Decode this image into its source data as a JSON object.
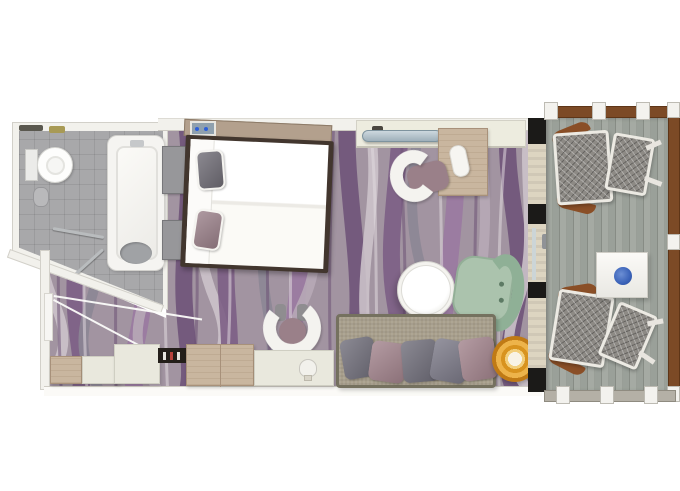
{
  "page": {
    "title": "Balcony stateroom floor plan"
  },
  "rooms": {
    "bathroom": {
      "name": "Bathroom",
      "fixtures": [
        "toilet",
        "hand shower",
        "grab bars",
        "shower corner",
        "bathtub with seat"
      ]
    },
    "stateroom": {
      "name": "Stateroom",
      "furniture": [
        "double bed with gray and mauve pillows",
        "two nightstands",
        "headboard panel with control pad",
        "TV console with wall-mounted TV",
        "writing desk",
        "desk chair with mauve cushion",
        "round white coffee table",
        "sage green armchair",
        "sofa with five cushions",
        "gold round pouf",
        "vanity chair",
        "wardrobe cabinets",
        "minibar niche",
        "vanity cabinet",
        "entrance door with swing"
      ]
    },
    "balcony": {
      "name": "Balcony",
      "furniture": [
        "woven lounge chair",
        "woven lounge chair",
        "white side table with blue bowl",
        "wood deck",
        "railing with posts"
      ]
    }
  },
  "colors": {
    "wall": "#f2f1ec",
    "bath-floor": "#a8a8aa",
    "carpet-base": "#a294a1",
    "bed-frame": "#42362e",
    "duvet": "#f7f6f2",
    "pillow-gray": "#6f6c75",
    "pillow-mauve": "#9a8089",
    "wood": "#c9b69f",
    "wood-dark": "#a8917a",
    "cream": "#e9e8dd",
    "sofa": "#a89f8c",
    "sofa-edge": "#75715f",
    "green-seat": "#abc3ad",
    "green-back": "#8fb096",
    "pouf-gold": "#e8a93c",
    "pouf-deep": "#c07a15",
    "deck": "#9ba19b",
    "rail-brown": "#7c4a26",
    "mesh": "#8d8a85",
    "divider": "#ddd5c1",
    "tv": "#aebfc9",
    "dish-blue": "#3a62b8",
    "white-fixture": "#f4f3ef"
  },
  "carpet_wave_colors": [
    "#cdc4cb",
    "#7b5d84",
    "#8b8694",
    "#9a79a0",
    "#b7aab6",
    "#6d5277"
  ]
}
